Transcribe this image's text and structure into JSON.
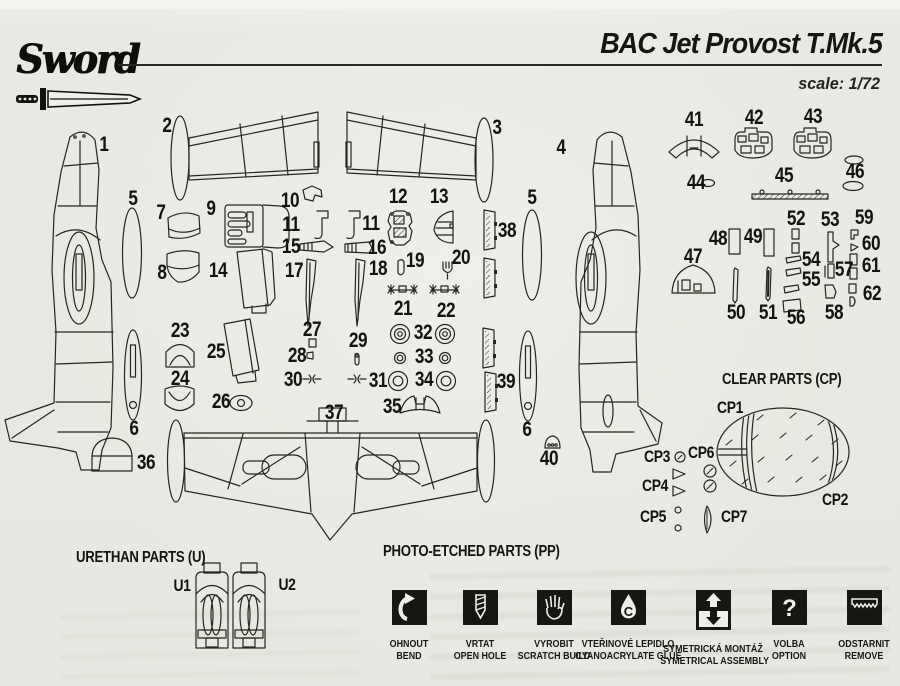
{
  "header": {
    "brand": "Sword",
    "title": "BAC Jet Provost T.Mk.5",
    "scale": "scale: 1/72"
  },
  "sections": {
    "clear_parts_heading": "CLEAR PARTS (CP)",
    "urethan_parts_heading": "URETHAN PARTS (U)",
    "photo_etched_heading": "PHOTO-ETCHED PARTS (PP)"
  },
  "part_labels": [
    {
      "t": "1",
      "x": 104,
      "y": 145,
      "k": "num"
    },
    {
      "t": "2",
      "x": 167,
      "y": 126,
      "k": "num"
    },
    {
      "t": "3",
      "x": 497,
      "y": 128,
      "k": "num"
    },
    {
      "t": "4",
      "x": 561,
      "y": 148,
      "k": "num"
    },
    {
      "t": "5",
      "x": 133,
      "y": 199,
      "k": "num"
    },
    {
      "t": "7",
      "x": 161,
      "y": 213,
      "k": "num"
    },
    {
      "t": "9",
      "x": 211,
      "y": 209,
      "k": "num"
    },
    {
      "t": "8",
      "x": 162,
      "y": 273,
      "k": "num"
    },
    {
      "t": "14",
      "x": 218,
      "y": 271,
      "k": "num"
    },
    {
      "t": "10",
      "x": 290,
      "y": 201,
      "k": "num"
    },
    {
      "t": "11",
      "x": 291,
      "y": 225,
      "k": "num"
    },
    {
      "t": "15",
      "x": 291,
      "y": 247,
      "k": "num"
    },
    {
      "t": "17",
      "x": 294,
      "y": 271,
      "k": "num"
    },
    {
      "t": "11",
      "x": 371,
      "y": 224,
      "k": "num"
    },
    {
      "t": "16",
      "x": 377,
      "y": 248,
      "k": "num"
    },
    {
      "t": "18",
      "x": 378,
      "y": 269,
      "k": "num"
    },
    {
      "t": "12",
      "x": 398,
      "y": 197,
      "k": "num"
    },
    {
      "t": "13",
      "x": 439,
      "y": 197,
      "k": "num"
    },
    {
      "t": "19",
      "x": 415,
      "y": 261,
      "k": "num"
    },
    {
      "t": "20",
      "x": 461,
      "y": 258,
      "k": "num"
    },
    {
      "t": "21",
      "x": 403,
      "y": 309,
      "k": "num"
    },
    {
      "t": "22",
      "x": 446,
      "y": 311,
      "k": "num"
    },
    {
      "t": "38",
      "x": 507,
      "y": 231,
      "k": "num"
    },
    {
      "t": "23",
      "x": 180,
      "y": 331,
      "k": "num"
    },
    {
      "t": "25",
      "x": 216,
      "y": 352,
      "k": "num"
    },
    {
      "t": "24",
      "x": 180,
      "y": 379,
      "k": "num"
    },
    {
      "t": "26",
      "x": 221,
      "y": 402,
      "k": "num"
    },
    {
      "t": "27",
      "x": 312,
      "y": 330,
      "k": "num"
    },
    {
      "t": "28",
      "x": 297,
      "y": 356,
      "k": "num"
    },
    {
      "t": "29",
      "x": 358,
      "y": 341,
      "k": "num"
    },
    {
      "t": "30",
      "x": 293,
      "y": 380,
      "k": "num"
    },
    {
      "t": "31",
      "x": 378,
      "y": 381,
      "k": "num"
    },
    {
      "t": "32",
      "x": 423,
      "y": 333,
      "k": "num"
    },
    {
      "t": "33",
      "x": 424,
      "y": 357,
      "k": "num"
    },
    {
      "t": "34",
      "x": 424,
      "y": 380,
      "k": "num"
    },
    {
      "t": "35",
      "x": 392,
      "y": 407,
      "k": "num"
    },
    {
      "t": "37",
      "x": 334,
      "y": 413,
      "k": "num"
    },
    {
      "t": "6",
      "x": 134,
      "y": 429,
      "k": "num"
    },
    {
      "t": "36",
      "x": 146,
      "y": 463,
      "k": "num"
    },
    {
      "t": "5",
      "x": 532,
      "y": 198,
      "k": "num"
    },
    {
      "t": "39",
      "x": 506,
      "y": 382,
      "k": "num"
    },
    {
      "t": "6",
      "x": 527,
      "y": 430,
      "k": "num"
    },
    {
      "t": "40",
      "x": 549,
      "y": 459,
      "k": "num"
    },
    {
      "t": "41",
      "x": 694,
      "y": 120,
      "k": "num"
    },
    {
      "t": "42",
      "x": 754,
      "y": 118,
      "k": "num"
    },
    {
      "t": "43",
      "x": 813,
      "y": 117,
      "k": "num"
    },
    {
      "t": "44",
      "x": 696,
      "y": 183,
      "k": "num"
    },
    {
      "t": "45",
      "x": 784,
      "y": 176,
      "k": "num"
    },
    {
      "t": "46",
      "x": 855,
      "y": 172,
      "k": "num"
    },
    {
      "t": "47",
      "x": 693,
      "y": 257,
      "k": "num"
    },
    {
      "t": "48",
      "x": 718,
      "y": 239,
      "k": "num"
    },
    {
      "t": "49",
      "x": 753,
      "y": 237,
      "k": "num"
    },
    {
      "t": "50",
      "x": 736,
      "y": 313,
      "k": "num"
    },
    {
      "t": "51",
      "x": 768,
      "y": 313,
      "k": "num"
    },
    {
      "t": "52",
      "x": 796,
      "y": 219,
      "k": "num"
    },
    {
      "t": "53",
      "x": 830,
      "y": 220,
      "k": "num"
    },
    {
      "t": "54",
      "x": 811,
      "y": 260,
      "k": "num"
    },
    {
      "t": "55",
      "x": 811,
      "y": 280,
      "k": "num"
    },
    {
      "t": "56",
      "x": 796,
      "y": 318,
      "k": "num"
    },
    {
      "t": "57",
      "x": 844,
      "y": 270,
      "k": "num"
    },
    {
      "t": "58",
      "x": 834,
      "y": 313,
      "k": "num"
    },
    {
      "t": "59",
      "x": 864,
      "y": 218,
      "k": "num"
    },
    {
      "t": "60",
      "x": 871,
      "y": 244,
      "k": "num"
    },
    {
      "t": "61",
      "x": 871,
      "y": 266,
      "k": "num"
    },
    {
      "t": "62",
      "x": 872,
      "y": 294,
      "k": "num"
    },
    {
      "t": "CP1",
      "x": 730,
      "y": 408,
      "k": "alpha"
    },
    {
      "t": "CP2",
      "x": 835,
      "y": 500,
      "k": "alpha"
    },
    {
      "t": "CP3",
      "x": 657,
      "y": 457,
      "k": "alpha"
    },
    {
      "t": "CP6",
      "x": 701,
      "y": 453,
      "k": "alpha"
    },
    {
      "t": "CP4",
      "x": 655,
      "y": 486,
      "k": "alpha"
    },
    {
      "t": "CP5",
      "x": 653,
      "y": 517,
      "k": "alpha"
    },
    {
      "t": "CP7",
      "x": 734,
      "y": 517,
      "k": "alpha"
    },
    {
      "t": "U1",
      "x": 182,
      "y": 586,
      "k": "alpha"
    },
    {
      "t": "U2",
      "x": 287,
      "y": 585,
      "k": "alpha"
    }
  ],
  "legend": {
    "items": [
      {
        "icon": "bend-icon",
        "line1": "OHNOUT",
        "line2": "BEND"
      },
      {
        "icon": "drill-icon",
        "line1": "VRTAT",
        "line2": "OPEN HOLE"
      },
      {
        "icon": "scratch-build-icon",
        "line1": "VYROBIT",
        "line2": "SCRATCH BUILD"
      },
      {
        "icon": "glue-icon",
        "line1": "VTEŘINOVÉ LEPIDLO",
        "line2": "CYANOACRYLATE GLUE"
      },
      {
        "icon": "symmetrical-assembly-icon",
        "line1": "SYMETRICKÁ MONTÁŽ",
        "line2": "SYMETRICAL ASSEMBLY"
      },
      {
        "icon": "option-icon",
        "line1": "VOLBA",
        "line2": "OPTION"
      },
      {
        "icon": "remove-icon",
        "line1": "ODSTARNIT",
        "line2": "REMOVE"
      }
    ]
  },
  "colors": {
    "paper": "#e6e9e1",
    "ink": "#23231e"
  }
}
